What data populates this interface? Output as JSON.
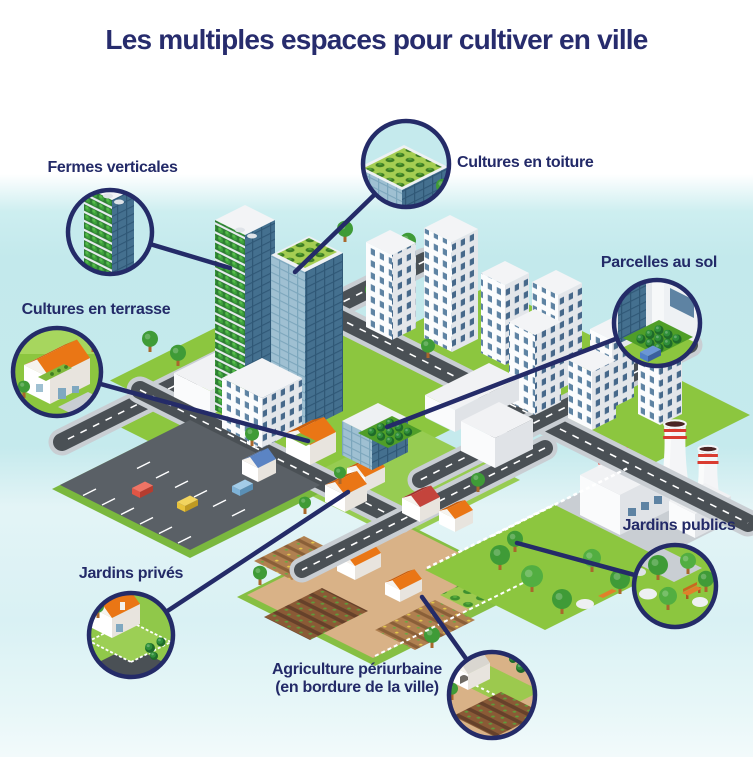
{
  "title": "Les multiples espaces pour cultiver en ville",
  "callouts": [
    {
      "id": "fermes-verticales",
      "label": "Fermes verticales"
    },
    {
      "id": "cultures-en-toiture",
      "label": "Cultures en toiture"
    },
    {
      "id": "parcelles-au-sol",
      "label": "Parcelles au sol"
    },
    {
      "id": "cultures-en-terrasse",
      "label": "Cultures en terrasse"
    },
    {
      "id": "jardins-prives",
      "label": "Jardins privés"
    },
    {
      "id": "jardins-publics",
      "label": "Jardins publics"
    },
    {
      "id": "agriculture-periurbaine",
      "label": "Agriculture périurbaine",
      "label_line2": "(en bordure de la ville)"
    }
  ],
  "city": {
    "market_sign": "MARKET"
  },
  "colors": {
    "navy": "#242b68",
    "sky_band": "#c5eaed",
    "grass": "#8cc63f",
    "road": "#4a5055",
    "roof_orange": "#ea7615",
    "farm_tan": "#d9b287",
    "glass_blue": "#44708f",
    "vertical_farm_green": "#1d6b2a",
    "cooling_tower_stripe": "#d93b30"
  }
}
